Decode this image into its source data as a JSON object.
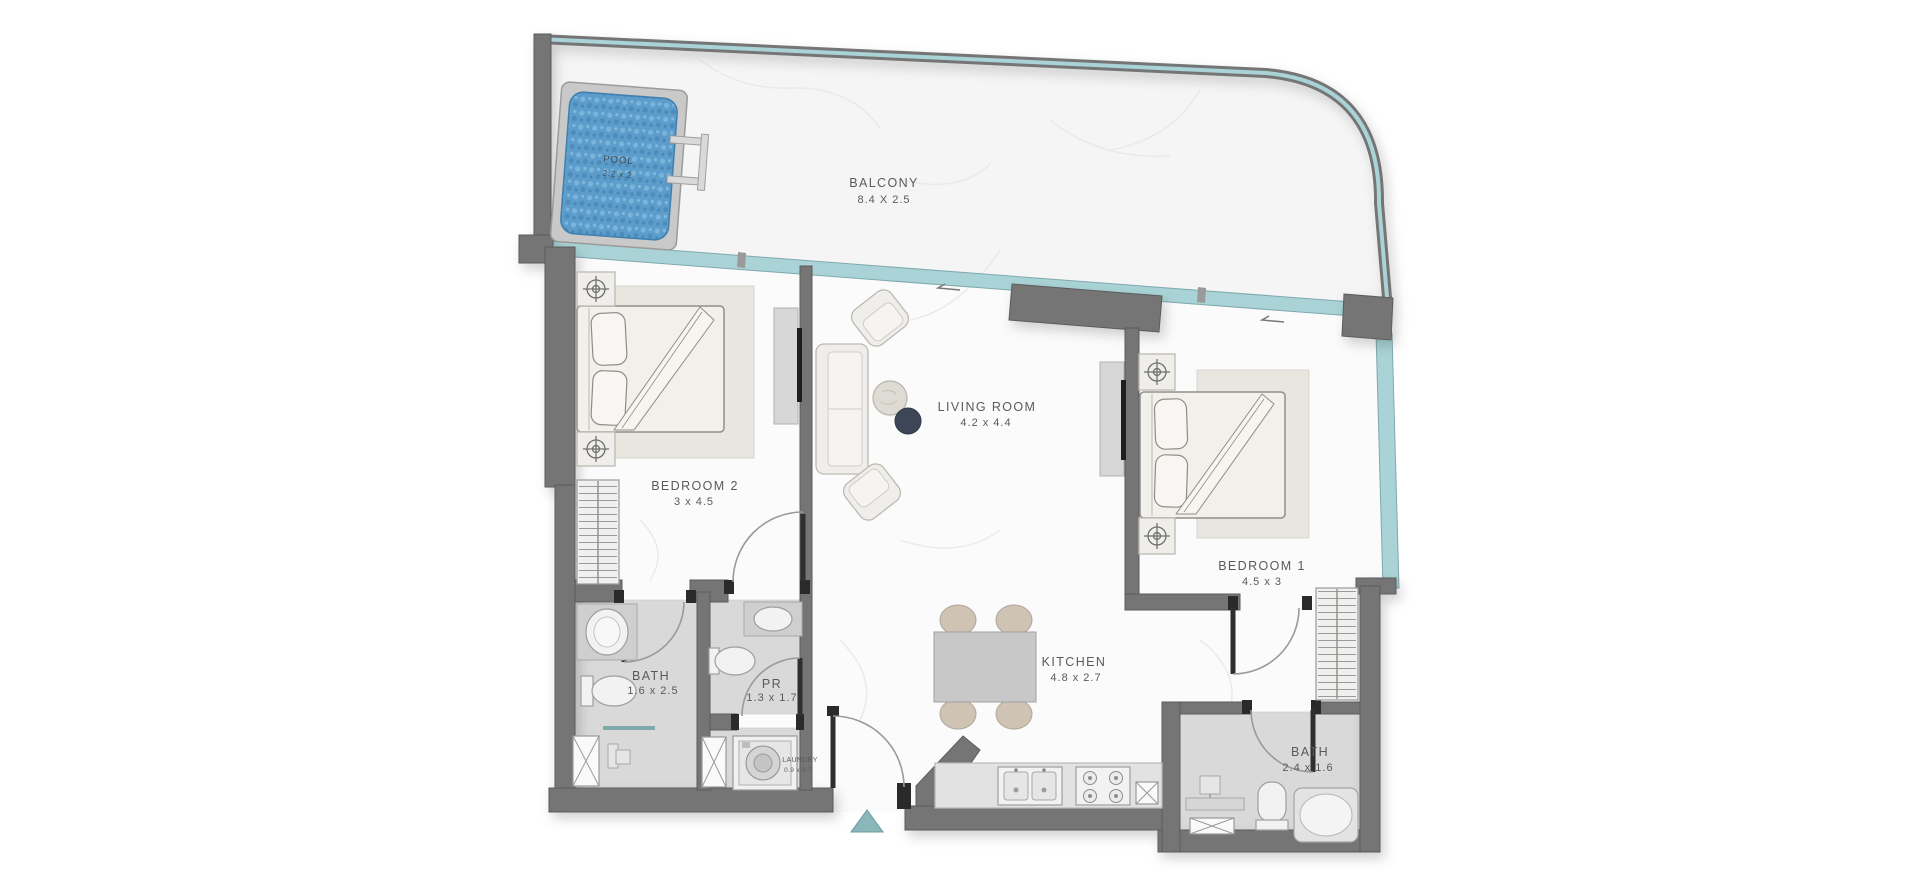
{
  "floor_plan": {
    "rooms": {
      "pool": {
        "label": "POOL",
        "dims": "2.2 x 2"
      },
      "balcony": {
        "label": "BALCONY",
        "dims": "8.4 X 2.5"
      },
      "bedroom2": {
        "label": "BEDROOM 2",
        "dims": "3 x 4.5"
      },
      "living_room": {
        "label": "LIVING ROOM",
        "dims": "4.2 x 4.4"
      },
      "bedroom1": {
        "label": "BEDROOM 1",
        "dims": "4.5 x 3"
      },
      "kitchen": {
        "label": "KITCHEN",
        "dims": "4.8 x 2.7"
      },
      "bath_left": {
        "label": "BATH",
        "dims": "1.6 x 2.5"
      },
      "powder_room": {
        "label": "PR",
        "dims": "1.3 x 1.7"
      },
      "laundry": {
        "label": "LAUNDRY",
        "dims": "0.9 x 0.7"
      },
      "bath_right": {
        "label": "BATH",
        "dims": "2.4 x 1.6"
      }
    },
    "colors": {
      "wall": "#757575",
      "wall_dark": "#5b5b5b",
      "glass": "#a9d3d6",
      "glass_frame": "#7fa9ad",
      "pool_water": "#5d9dcb",
      "floor": "#fbfbfc",
      "balcony_floor": "#f5f5f6",
      "bath_floor": "#d9d9d9",
      "rug": "#e9e6e0",
      "accent_navy": "#3c4656",
      "chair": "#cfc3b4",
      "entrance_marker": "#8bb7ba",
      "label_text": "#5a5a5a"
    }
  }
}
